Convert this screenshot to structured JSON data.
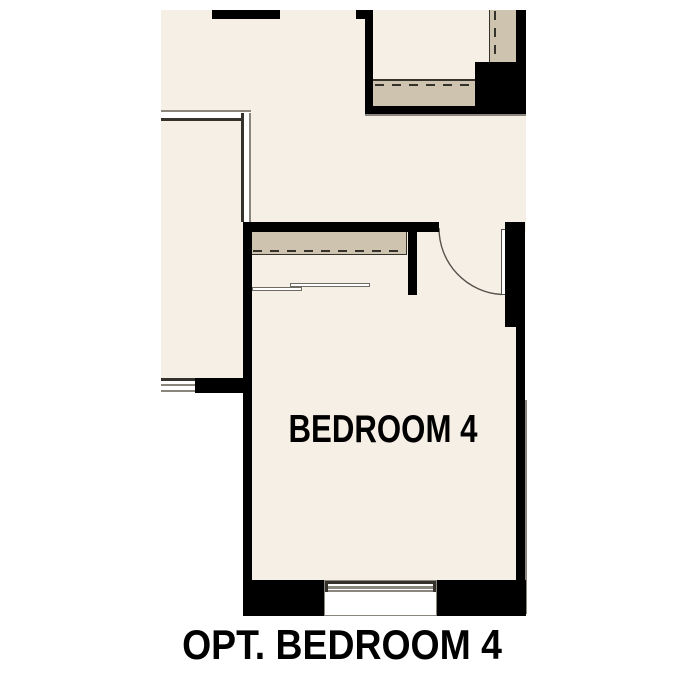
{
  "plan": {
    "room_label": "BEDROOM 4",
    "caption": "OPT. BEDROOM 4"
  },
  "colors": {
    "background": "#ffffff",
    "floor": "#f6efe5",
    "shelf": "#cdc3af",
    "wall": "#000000",
    "linedark": "#35322c",
    "linegrey": "#8a867e"
  }
}
